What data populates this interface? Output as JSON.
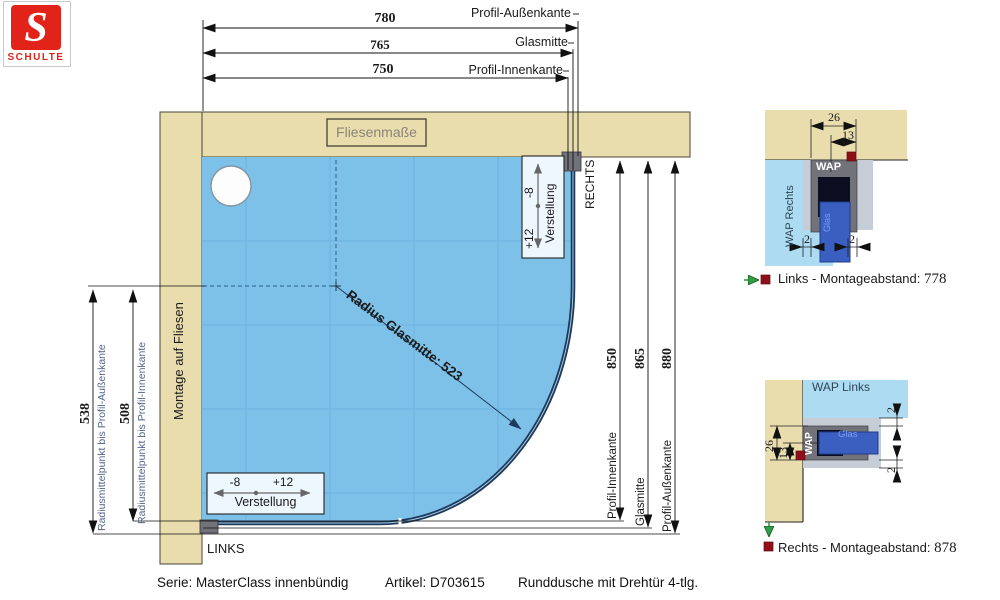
{
  "colors": {
    "wall": "#e9ddae",
    "wall_border": "#4a4435",
    "shower": "#7ec1e8",
    "tile": "#62aedd",
    "glass": "#1d3a5c",
    "profile": "#72727a",
    "profile_light": "#c6cdd6",
    "detail_blue": "#addcf2",
    "glass_panel": "#3a5fc0",
    "marker_red": "#8f1018",
    "green": "#2f9e44",
    "dim_blue": "#53648c",
    "logo_red": "#e2231a"
  },
  "logo": {
    "letter": "S",
    "name": "SCHULTE"
  },
  "dims_top": {
    "aussen": {
      "value": "780",
      "label": "Profil-Außenkante"
    },
    "mitte": {
      "value": "765",
      "label": "Glasmitte"
    },
    "innen": {
      "value": "750",
      "label": "Profil-Innenkante"
    }
  },
  "dims_right": {
    "innen": {
      "value": "850",
      "label": "Profil-Innenkante"
    },
    "mitte": {
      "value": "865",
      "label": "Glasmitte"
    },
    "aussen": {
      "value": "880",
      "label": "Profil-Außenkante"
    },
    "side_label": "RECHTS"
  },
  "dims_left": {
    "aussen": {
      "value": "538",
      "label": "Radiusmittelpunkt bis Profil-Außenkante"
    },
    "innen": {
      "value": "508",
      "label": "Radiusmittelpunkt bis Profil-Innenkante"
    }
  },
  "plan": {
    "tiles_label": "Fliesenmaße",
    "wall_label": "Montage auf Fliesen",
    "radius_label": "Radius Glasmitte: 523",
    "side_label": "LINKS",
    "adjust": {
      "minus": "-8",
      "plus": "+12",
      "label": "Verstellung"
    }
  },
  "detail_top": {
    "area_label": "WAP Rechts",
    "profile_label": "WAP",
    "glass_label": "Glas",
    "dim_width": "26",
    "dim_center": "13",
    "dim_gap_left": "2",
    "dim_gap_right": "2",
    "caption": "Links - Montageabstand:",
    "caption_value": "778"
  },
  "detail_bottom": {
    "area_label": "WAP Links",
    "profile_label": "WAP",
    "glass_label": "Glas",
    "dim_width": "26",
    "dim_center": "13",
    "dim_gap_top": "2",
    "dim_gap_bottom": "2",
    "caption": "Rechts - Montageabstand:",
    "caption_value": "878"
  },
  "footer": {
    "series": "Serie: MasterClass innenbündig",
    "article": "Artikel: D703615",
    "product": "Runddusche mit Drehtür 4-tlg."
  }
}
